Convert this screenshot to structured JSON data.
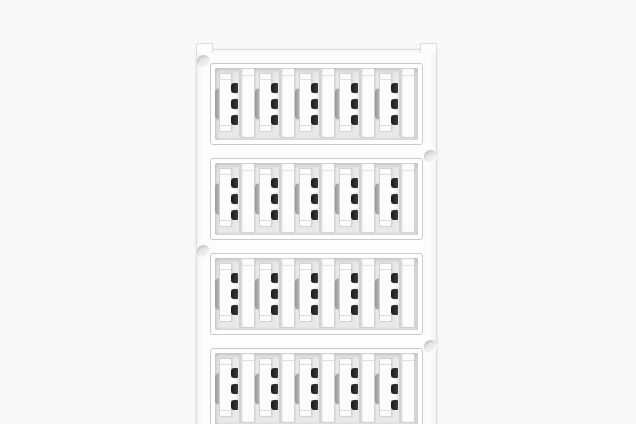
{
  "meta": {
    "type": "product-photo",
    "subject": "White plastic cable-marker card with snap-in marker strips",
    "visible_text": "none"
  },
  "card": {
    "row_count": 4,
    "markers_per_row": 5,
    "fourth_row_cropped_at_bottom": true,
    "mounting_holes": [
      {
        "side": "left",
        "position": "row-1"
      },
      {
        "side": "right",
        "position": "row-2"
      },
      {
        "side": "left",
        "position": "row-3"
      },
      {
        "side": "right",
        "position": "row-4"
      }
    ]
  },
  "colors": {
    "page_background": "#f8f8f8",
    "card_surface": "#fdfdfd",
    "card_edge": "#dcdcdc",
    "interior_edge": "#c9c9c9",
    "row_interior": "#e9e9e9",
    "strip_surface": "#fcfcfc",
    "strip_edge": "#d2d2d2",
    "clip_notch": "#1a1a1a",
    "clip_bulge_dark": "#9a9a9a",
    "clip_bulge_light": "#d2d2d2"
  }
}
